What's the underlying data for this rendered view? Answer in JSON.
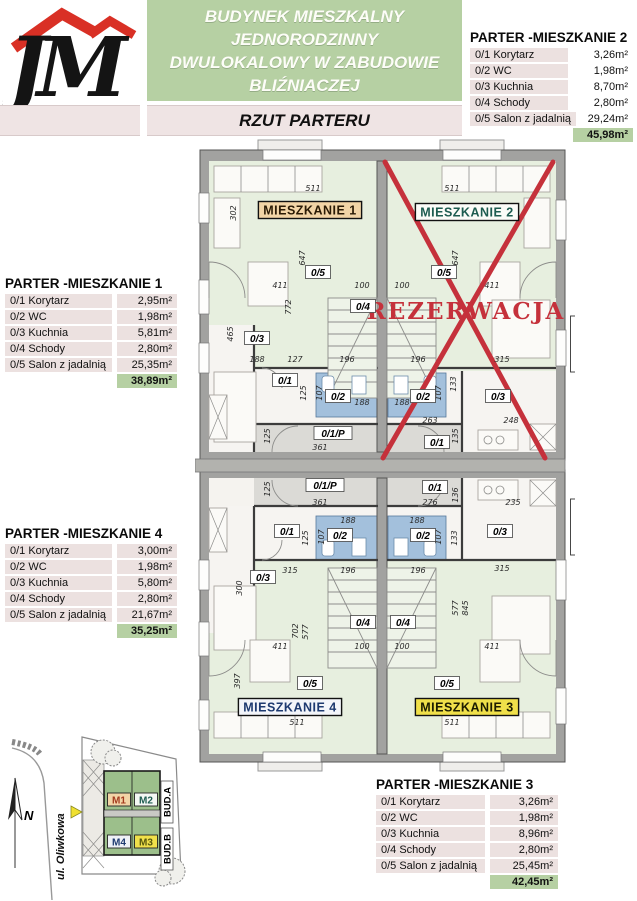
{
  "header": {
    "logo_text": "JM",
    "title_lines": [
      "BUDYNEK MIESZKALNY",
      "JEDNORODZINNY",
      "DWULOKALOWY W ZABUDOWIE",
      "BLIŹNIACZEJ"
    ],
    "subtitle": "RZUT PARTERU"
  },
  "colors": {
    "green": "#b6d0a3",
    "row_pink": "#ece1e0",
    "red": "#c5313b",
    "wc_blue": "#a3c0dc",
    "living_green": "#e7efdf",
    "site_building_green": "#9cbf8b"
  },
  "tables": [
    {
      "id": "m1",
      "title": "PARTER -MIESZKANIE 1",
      "rows": [
        [
          "0/1 Korytarz",
          "2,95m²"
        ],
        [
          "0/2 WC",
          "1,98m²"
        ],
        [
          "0/3 Kuchnia",
          "5,81m²"
        ],
        [
          "0/4 Schody",
          "2,80m²"
        ],
        [
          "0/5 Salon z jadalnią",
          "25,35m²"
        ]
      ],
      "total": "38,89m²"
    },
    {
      "id": "m2",
      "title": "PARTER -MIESZKANIE 2",
      "rows": [
        [
          "0/1 Korytarz",
          "3,26m²"
        ],
        [
          "0/2 WC",
          "1,98m²"
        ],
        [
          "0/3 Kuchnia",
          "8,70m²"
        ],
        [
          "0/4 Schody",
          "2,80m²"
        ],
        [
          "0/5 Salon z jadalnią",
          "29,24m²"
        ]
      ],
      "total": "45,98m²"
    },
    {
      "id": "m4",
      "title": "PARTER -MIESZKANIE 4",
      "rows": [
        [
          "0/1 Korytarz",
          "3,00m²"
        ],
        [
          "0/2 WC",
          "1,98m²"
        ],
        [
          "0/3 Kuchnia",
          "5,80m²"
        ],
        [
          "0/4 Schody",
          "2,80m²"
        ],
        [
          "0/5 Salon z jadalnią",
          "21,67m²"
        ]
      ],
      "total": "35,25m²"
    },
    {
      "id": "m3",
      "title": "PARTER -MIESZKANIE 3",
      "rows": [
        [
          "0/1 Korytarz",
          "3,26m²"
        ],
        [
          "0/2 WC",
          "1,98m²"
        ],
        [
          "0/3 Kuchnia",
          "8,96m²"
        ],
        [
          "0/4 Schody",
          "2,80m²"
        ],
        [
          "0/5 Salon z jadalnią",
          "25,45m²"
        ]
      ],
      "total": "42,45m²"
    }
  ],
  "plan": {
    "reservation": "REZERWACJA",
    "apartment_labels": [
      {
        "t": "MIESZKANIE 1",
        "x": 310,
        "y": 210,
        "bg": "#f2d4a6",
        "fg": "#2a1a05"
      },
      {
        "t": "MIESZKANIE 2",
        "x": 467,
        "y": 212,
        "bg": "#fbfcf8",
        "fg": "#1d5c50"
      },
      {
        "t": "MIESZKANIE 4",
        "x": 290,
        "y": 707,
        "bg": "#f3f5fa",
        "fg": "#1e3a70"
      },
      {
        "t": "MIESZKANIE 3",
        "x": 467,
        "y": 707,
        "bg": "#f0e04a",
        "fg": "#1c1c00"
      }
    ],
    "bud_labels": [
      {
        "t": "BUD.A",
        "x": 580,
        "y": 344
      },
      {
        "t": "BUD.B",
        "x": 580,
        "y": 527
      }
    ],
    "room_labels": [
      {
        "t": "0/5",
        "x": 318,
        "y": 273
      },
      {
        "t": "0/5",
        "x": 444,
        "y": 273
      },
      {
        "t": "0/4",
        "x": 363,
        "y": 307
      },
      {
        "t": "0/3",
        "x": 257,
        "y": 339
      },
      {
        "t": "0/1",
        "x": 285,
        "y": 381
      },
      {
        "t": "0/2",
        "x": 338,
        "y": 397
      },
      {
        "t": "0/2",
        "x": 423,
        "y": 397
      },
      {
        "t": "0/3",
        "x": 498,
        "y": 397
      },
      {
        "t": "0/1/P",
        "x": 333,
        "y": 434
      },
      {
        "t": "0/1",
        "x": 437,
        "y": 443
      },
      {
        "t": "0/1/P",
        "x": 325,
        "y": 486
      },
      {
        "t": "0/1",
        "x": 435,
        "y": 488
      },
      {
        "t": "0/1",
        "x": 287,
        "y": 532
      },
      {
        "t": "0/2",
        "x": 340,
        "y": 536
      },
      {
        "t": "0/2",
        "x": 423,
        "y": 536
      },
      {
        "t": "0/3",
        "x": 500,
        "y": 532
      },
      {
        "t": "0/3",
        "x": 263,
        "y": 578
      },
      {
        "t": "0/4",
        "x": 363,
        "y": 623
      },
      {
        "t": "0/4",
        "x": 403,
        "y": 623
      },
      {
        "t": "0/5",
        "x": 310,
        "y": 684
      },
      {
        "t": "0/5",
        "x": 447,
        "y": 684
      }
    ],
    "dimensions": [
      {
        "t": "511",
        "x": 313,
        "y": 191
      },
      {
        "t": "511",
        "x": 452,
        "y": 191
      },
      {
        "t": "302",
        "x": 236,
        "y": 213,
        "r": -90
      },
      {
        "t": "647",
        "x": 305,
        "y": 258,
        "r": -90
      },
      {
        "t": "647",
        "x": 458,
        "y": 258,
        "r": -90
      },
      {
        "t": "411",
        "x": 280,
        "y": 288
      },
      {
        "t": "100",
        "x": 362,
        "y": 288
      },
      {
        "t": "100",
        "x": 402,
        "y": 288
      },
      {
        "t": "411",
        "x": 492,
        "y": 288
      },
      {
        "t": "772",
        "x": 291,
        "y": 307,
        "r": -90
      },
      {
        "t": "465",
        "x": 233,
        "y": 334,
        "r": -90
      },
      {
        "t": "188",
        "x": 257,
        "y": 362
      },
      {
        "t": "127",
        "x": 295,
        "y": 362
      },
      {
        "t": "196",
        "x": 347,
        "y": 362
      },
      {
        "t": "196",
        "x": 418,
        "y": 362
      },
      {
        "t": "315",
        "x": 502,
        "y": 362
      },
      {
        "t": "125",
        "x": 306,
        "y": 393,
        "r": -90
      },
      {
        "t": "107",
        "x": 322,
        "y": 393,
        "r": -90
      },
      {
        "t": "188",
        "x": 362,
        "y": 405
      },
      {
        "t": "188",
        "x": 402,
        "y": 405
      },
      {
        "t": "107",
        "x": 441,
        "y": 393,
        "r": -90
      },
      {
        "t": "133",
        "x": 456,
        "y": 384,
        "r": -90
      },
      {
        "t": "263",
        "x": 430,
        "y": 423
      },
      {
        "t": "248",
        "x": 511,
        "y": 423
      },
      {
        "t": "125",
        "x": 270,
        "y": 436,
        "r": -90
      },
      {
        "t": "361",
        "x": 320,
        "y": 450
      },
      {
        "t": "135",
        "x": 458,
        "y": 436,
        "r": -90
      },
      {
        "t": "125",
        "x": 270,
        "y": 489,
        "r": -90
      },
      {
        "t": "361",
        "x": 320,
        "y": 505
      },
      {
        "t": "276",
        "x": 430,
        "y": 505
      },
      {
        "t": "136",
        "x": 458,
        "y": 495,
        "r": -90
      },
      {
        "t": "235",
        "x": 513,
        "y": 505
      },
      {
        "t": "188",
        "x": 348,
        "y": 523
      },
      {
        "t": "188",
        "x": 417,
        "y": 523
      },
      {
        "t": "125",
        "x": 308,
        "y": 538,
        "r": -90
      },
      {
        "t": "107",
        "x": 324,
        "y": 537,
        "r": -90
      },
      {
        "t": "107",
        "x": 441,
        "y": 537,
        "r": -90
      },
      {
        "t": "133",
        "x": 457,
        "y": 538,
        "r": -90
      },
      {
        "t": "315",
        "x": 290,
        "y": 573
      },
      {
        "t": "196",
        "x": 348,
        "y": 573
      },
      {
        "t": "196",
        "x": 418,
        "y": 573
      },
      {
        "t": "315",
        "x": 502,
        "y": 571
      },
      {
        "t": "300",
        "x": 242,
        "y": 588,
        "r": -90
      },
      {
        "t": "577",
        "x": 458,
        "y": 608,
        "r": -90
      },
      {
        "t": "845",
        "x": 468,
        "y": 608,
        "r": -90
      },
      {
        "t": "702",
        "x": 298,
        "y": 631,
        "r": -90
      },
      {
        "t": "577",
        "x": 308,
        "y": 632,
        "r": -90
      },
      {
        "t": "411",
        "x": 280,
        "y": 649
      },
      {
        "t": "100",
        "x": 362,
        "y": 649
      },
      {
        "t": "100",
        "x": 402,
        "y": 649
      },
      {
        "t": "411",
        "x": 492,
        "y": 649
      },
      {
        "t": "397",
        "x": 240,
        "y": 681,
        "r": -90
      },
      {
        "t": "511",
        "x": 297,
        "y": 725
      },
      {
        "t": "511",
        "x": 452,
        "y": 725
      }
    ]
  },
  "site_plan": {
    "street": "ul. Oliwkowa",
    "north": "N",
    "unit_labels": [
      {
        "t": "M1",
        "x": 119,
        "y": 72,
        "bg": "#f2d4a6",
        "fg": "#a33a1e"
      },
      {
        "t": "M2",
        "x": 146,
        "y": 72,
        "bg": "#f3f7f3",
        "fg": "#1d5c50"
      },
      {
        "t": "M4",
        "x": 119,
        "y": 114,
        "bg": "#eef1f6",
        "fg": "#1e3a70"
      },
      {
        "t": "M3",
        "x": 146,
        "y": 114,
        "bg": "#f0e04a",
        "fg": "#57570e"
      }
    ],
    "bud_labels": [
      {
        "t": "BUD.A",
        "x": 167,
        "y": 74
      },
      {
        "t": "BUD.B",
        "x": 167,
        "y": 121
      }
    ]
  }
}
